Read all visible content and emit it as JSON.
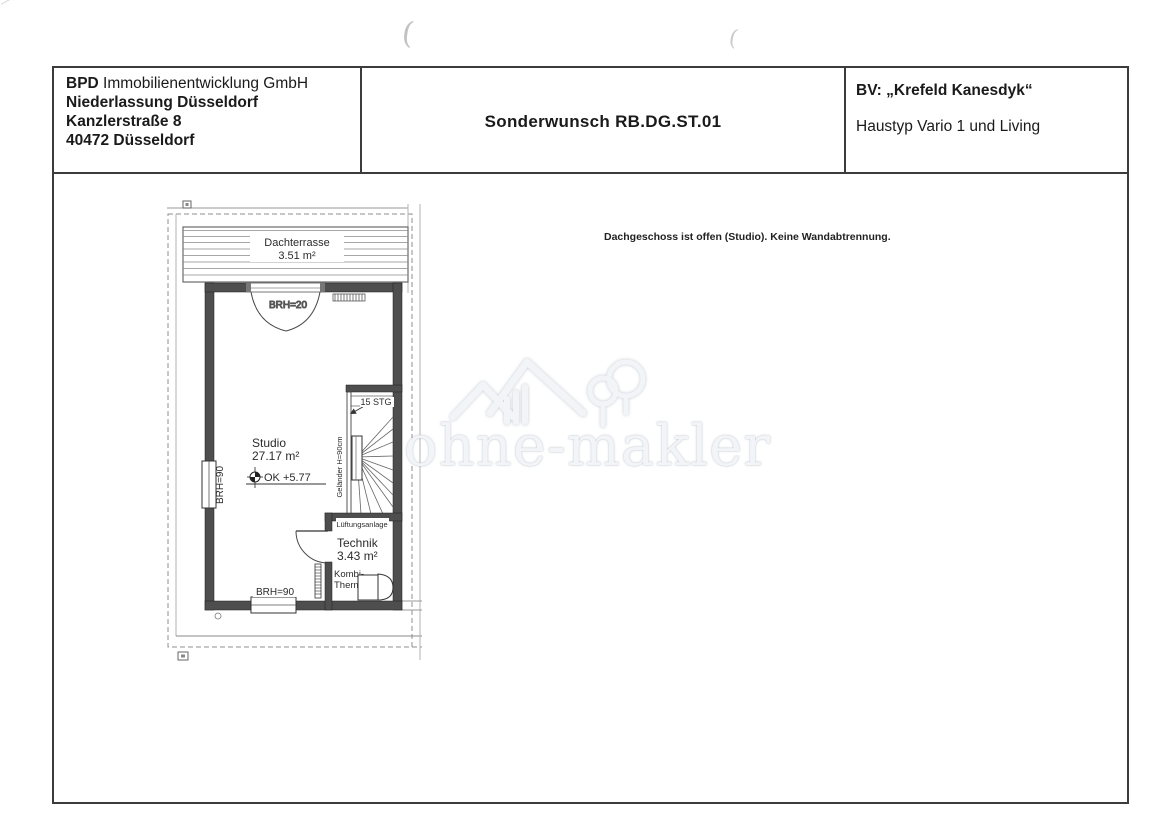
{
  "header": {
    "company": {
      "brand": "BPD",
      "name_rest": " Immobilienentwicklung GmbH",
      "branch": "Niederlassung Düsseldorf",
      "street": "Kanzlerstraße 8",
      "city": "40472 Düsseldorf"
    },
    "title": "Sonderwunsch RB.DG.ST.01",
    "project": {
      "bv": "BV: „Krefeld Kanesdyk“",
      "haustyp": "Haustyp Vario 1 und Living"
    }
  },
  "note": "Dachgeschoss ist offen (Studio). Keine Wandabtrennung.",
  "plan": {
    "terrace_name": "Dachterrasse",
    "terrace_area": "3.51 m²",
    "studio_name": "Studio",
    "studio_area": "27.17 m²",
    "technik_name": "Technik",
    "technik_area": "3.43 m²",
    "door_sill": "BRH=20",
    "window_left_sill": "BRH=90",
    "window_bottom_sill": "BRH=90",
    "level_mark": "OK  +5.77",
    "stair_count": "15 STG",
    "railing": "Geländer  H=90cm",
    "ventilation": "Lüftungsanlage",
    "boiler_l1": "Kombi-",
    "boiler_l2": "Therme"
  },
  "watermark": {
    "text": "ohne-makler"
  },
  "artifacts": {
    "paren1": "(",
    "paren2": "("
  }
}
